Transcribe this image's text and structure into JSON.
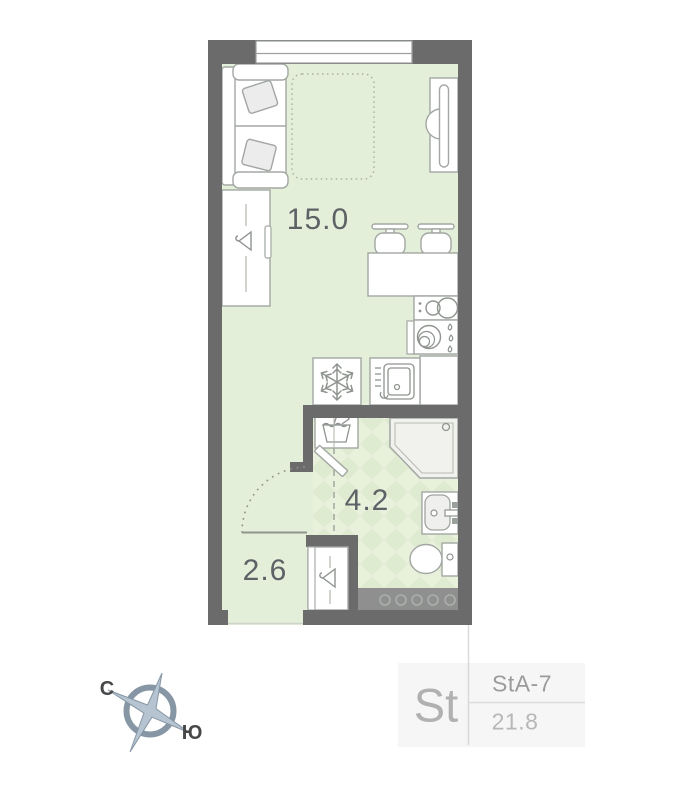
{
  "floorplan": {
    "rooms": [
      {
        "name": "living-room",
        "area": "15.0"
      },
      {
        "name": "bathroom",
        "area": "4.2"
      },
      {
        "name": "hallway",
        "area": "2.6"
      }
    ],
    "compass": {
      "north_label": "С",
      "south_label": "Ю"
    },
    "unit_card": {
      "type_abbr": "St",
      "layout_code": "StA-7",
      "total_area": "21.8"
    },
    "colors": {
      "wall": "#6b6b6b",
      "floor": "#e4efd9",
      "tile_light": "#e9f1dd",
      "tile_dark": "#dfebd0",
      "furniture_stroke": "#a3a7a3",
      "icon_stroke": "#8f948f",
      "shaft_band": "#8f8f8f",
      "label_text": "#5d6266",
      "card_bg": "#f5f6f5",
      "compass_accent": "#8796a4"
    },
    "icons": {
      "hanger": "hanger-icon",
      "snowflake": "snowflake-icon",
      "laundry": "washing-machine-icon",
      "dishwasher": "dishwasher-icon",
      "cooktop": "cooktop-icon",
      "plates": "kitchen-sink-icon",
      "compass": "compass-rose-icon"
    }
  }
}
